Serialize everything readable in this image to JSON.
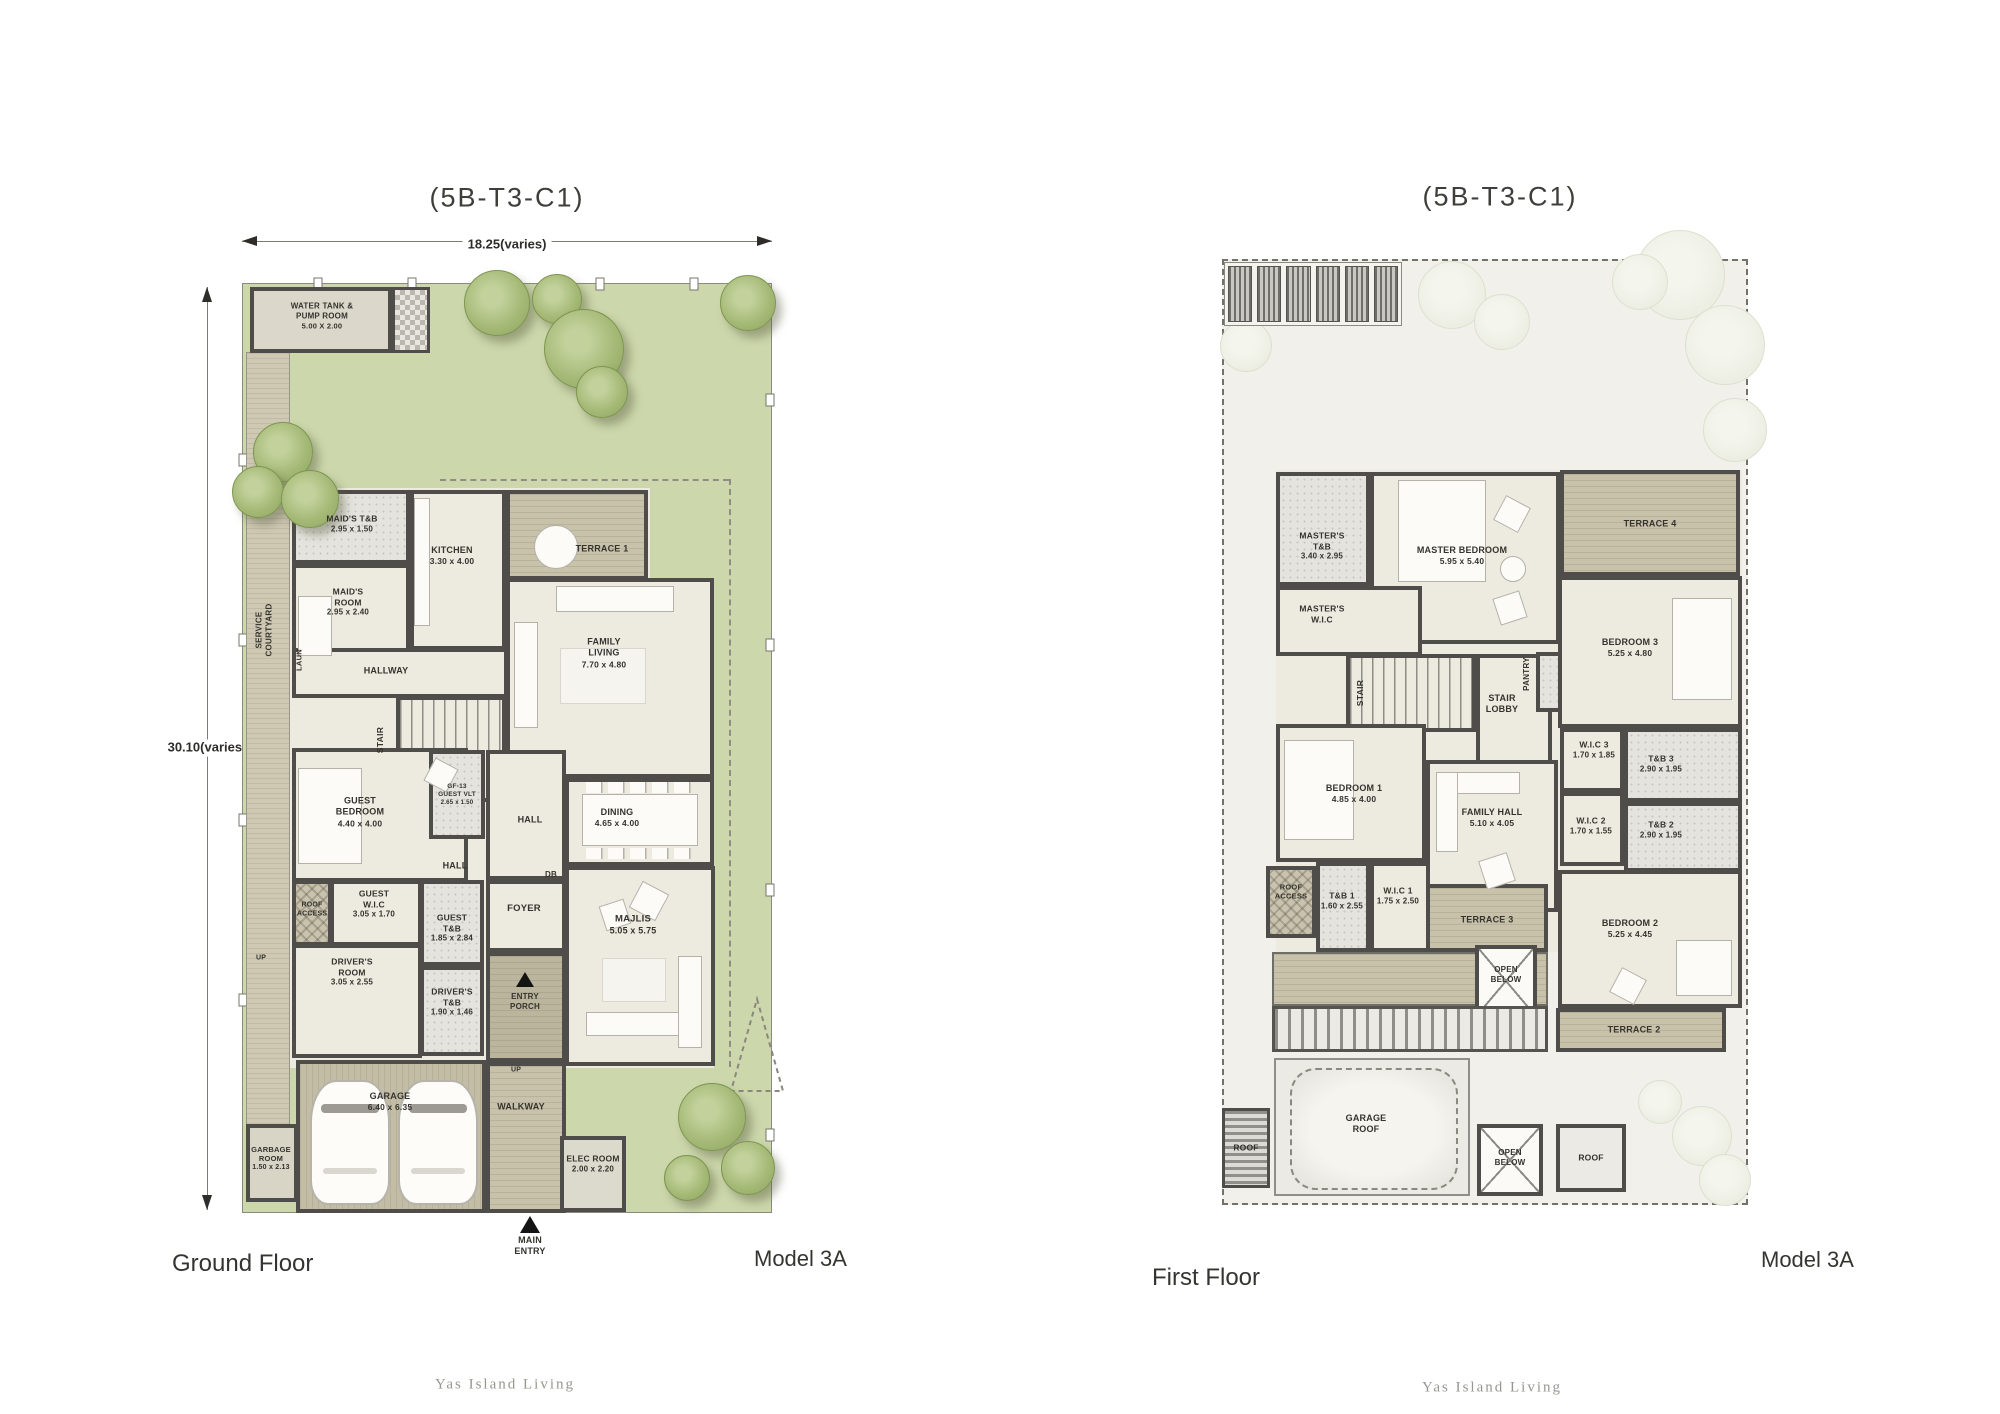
{
  "header": {
    "left_title": "(5B-T3-C1)",
    "right_title": "(5B-T3-C1)"
  },
  "dims": {
    "width": "18.25",
    "width_note": "(varies)",
    "height": "30.10",
    "height_note": "(varies)"
  },
  "footer": {
    "left_floor": "Ground Floor",
    "right_floor": "First Floor",
    "model_left": "Model 3A",
    "model_right": "Model 3A",
    "brand_left": "Yas Island Living",
    "brand_right": "Yas Island Living"
  },
  "gf": {
    "water_tank": {
      "name": "WATER TANK &\nPUMP ROOM",
      "dims": "5.00 X 2.00"
    },
    "maids_tb": {
      "name": "MAID'S T&B",
      "dims": "2.95 x 1.50"
    },
    "maids_room": {
      "name": "MAID'S\nROOM",
      "dims": "2.95 x 2.40"
    },
    "kitchen": {
      "name": "KITCHEN",
      "dims": "3.30 x 4.00"
    },
    "terrace1": {
      "name": "TERRACE 1"
    },
    "family_living": {
      "name": "FAMILY\nLIVING",
      "dims": "7.70 x 4.80"
    },
    "hallway": {
      "name": "HALLWAY"
    },
    "stair": {
      "name": "STAIR"
    },
    "laun": {
      "name": "LAUN"
    },
    "service_courtyard": {
      "name": "SERVICE\nCOURTYARD"
    },
    "guest_bedroom": {
      "name": "GUEST\nBEDROOM",
      "dims": "4.40 x 4.00"
    },
    "guest_vlt": {
      "name": "GF-13\nGUEST VLT",
      "dims": "2.65 x 1.50"
    },
    "hall_upper": {
      "name": "HALL"
    },
    "hall_lower": {
      "name": "HALL"
    },
    "db": {
      "name": "DB"
    },
    "dining": {
      "name": "DINING",
      "dims": "4.65 x 4.00"
    },
    "foyer": {
      "name": "FOYER"
    },
    "majlis": {
      "name": "MAJLIS",
      "dims": "5.05 x 5.75"
    },
    "roof_access": {
      "name": "ROOF\nACCESS"
    },
    "guest_wic": {
      "name": "GUEST\nW.I.C",
      "dims": "3.05 x 1.70"
    },
    "guest_tb": {
      "name": "GUEST\nT&B",
      "dims": "1.85 x 2.84"
    },
    "drivers_room": {
      "name": "DRIVER'S\nROOM",
      "dims": "3.05 x 2.55"
    },
    "drivers_tb": {
      "name": "DRIVER'S\nT&B",
      "dims": "1.90 x 1.46"
    },
    "entry_porch": {
      "name": "ENTRY\nPORCH"
    },
    "garage": {
      "name": "GARAGE",
      "dims": "6.40 x 6.35"
    },
    "garbage_room": {
      "name": "GARBAGE\nROOM",
      "dims": "1.50 x 2.13"
    },
    "walkway": {
      "name": "WALKWAY"
    },
    "elec_room": {
      "name": "ELEC ROOM",
      "dims": "2.00 x 2.20"
    },
    "main_entry": {
      "name": "MAIN\nENTRY"
    },
    "up1": {
      "name": "UP"
    },
    "up2": {
      "name": "UP"
    }
  },
  "ff": {
    "masters_tb": {
      "name": "MASTER'S\nT&B",
      "dims": "3.40 x 2.95"
    },
    "master_bedroom": {
      "name": "MASTER BEDROOM",
      "dims": "5.95 x 5.40"
    },
    "terrace4": {
      "name": "TERRACE 4"
    },
    "masters_wic": {
      "name": "MASTER'S\nW.I.C"
    },
    "stair": {
      "name": "STAIR"
    },
    "stair_lobby": {
      "name": "STAIR\nLOBBY"
    },
    "pantry": {
      "name": "PANTRY"
    },
    "bedroom3": {
      "name": "BEDROOM 3",
      "dims": "5.25 x 4.80"
    },
    "wic3": {
      "name": "W.I.C 3",
      "dims": "1.70 x 1.85"
    },
    "tb3": {
      "name": "T&B 3",
      "dims": "2.90 x 1.95"
    },
    "bedroom1": {
      "name": "BEDROOM 1",
      "dims": "4.85 x 4.00"
    },
    "family_hall": {
      "name": "FAMILY HALL",
      "dims": "5.10 x 4.05"
    },
    "wic2": {
      "name": "W.I.C 2",
      "dims": "1.70 x 1.55"
    },
    "tb2": {
      "name": "T&B 2",
      "dims": "2.90 x 1.95"
    },
    "roof_access": {
      "name": "ROOF\nACCESS"
    },
    "tb1": {
      "name": "T&B 1",
      "dims": "1.60 x 2.55"
    },
    "wic1": {
      "name": "W.I.C 1",
      "dims": "1.75 x 2.50"
    },
    "terrace3": {
      "name": "TERRACE 3"
    },
    "open_below_upper": {
      "name": "OPEN\nBELOW"
    },
    "bedroom2": {
      "name": "BEDROOM 2",
      "dims": "5.25 x 4.45"
    },
    "terrace2": {
      "name": "TERRACE 2"
    },
    "garage_roof": {
      "name": "GARAGE\nROOF"
    },
    "roof_left": {
      "name": "ROOF"
    },
    "open_below_lower": {
      "name": "OPEN\nBELOW"
    },
    "roof_right": {
      "name": "ROOF"
    }
  },
  "colors": {
    "lawn": "#ccd7ab",
    "deck": "#c8c2ab",
    "wall": "#4e4d49",
    "interior": "#edeadf",
    "site_bg": "#f1f0ea",
    "tree": "#9db26d"
  }
}
